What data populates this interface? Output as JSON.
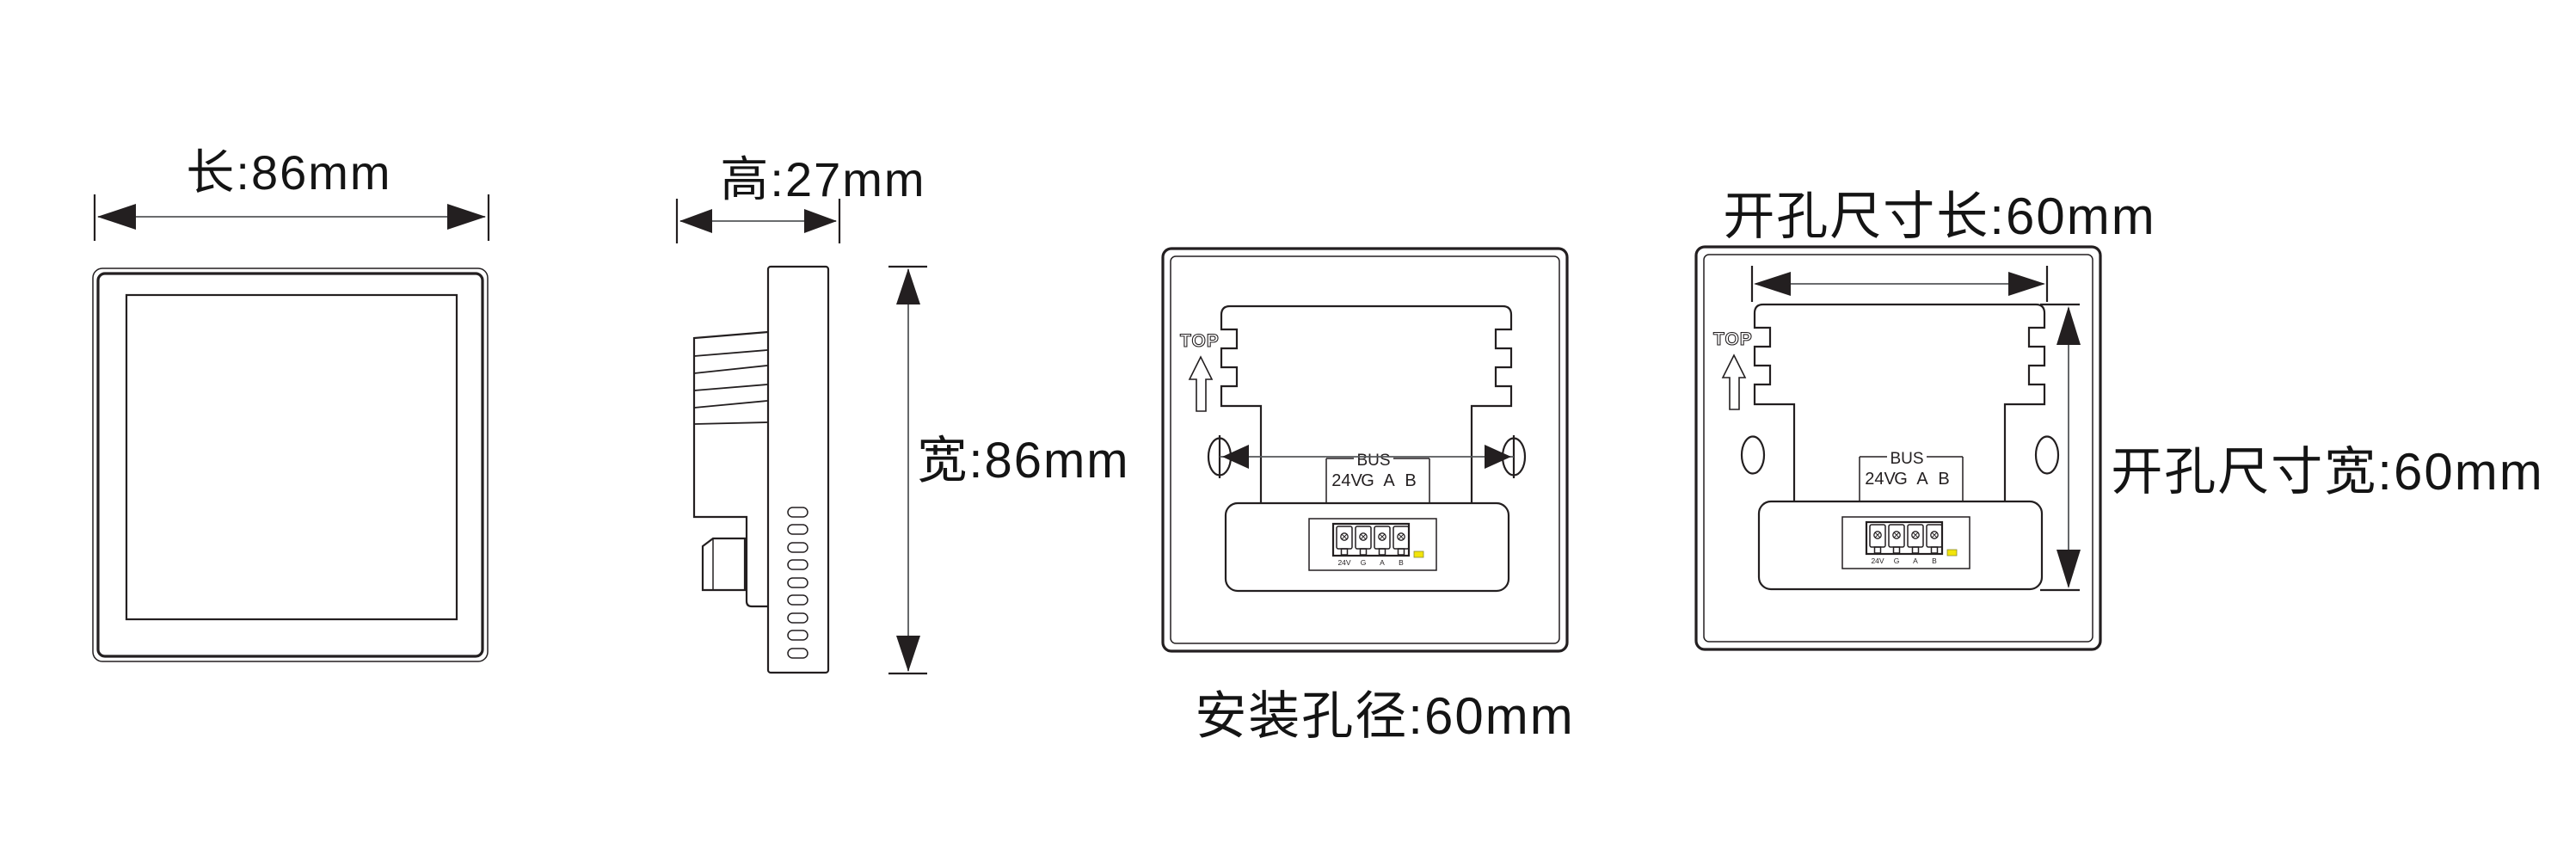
{
  "canvas": {
    "background": "#ffffff",
    "line_color": "#231f20",
    "dim_line_color": "#55575a",
    "led_color": "#f2e40a"
  },
  "front_view": {
    "length_label": "长:86mm"
  },
  "side_view": {
    "height_label": "高:27mm",
    "width_label": "宽:86mm"
  },
  "back_plate": {
    "top_marking": "TOP",
    "bus_marking": "BUS",
    "pin_labels": [
      "24V",
      "G",
      "A",
      "B"
    ]
  },
  "back_view_mounting": {
    "caption": "安装孔径:60mm"
  },
  "back_view_cutout": {
    "length_caption": "开孔尺寸长:60mm",
    "width_caption": "开孔尺寸宽:60mm"
  }
}
